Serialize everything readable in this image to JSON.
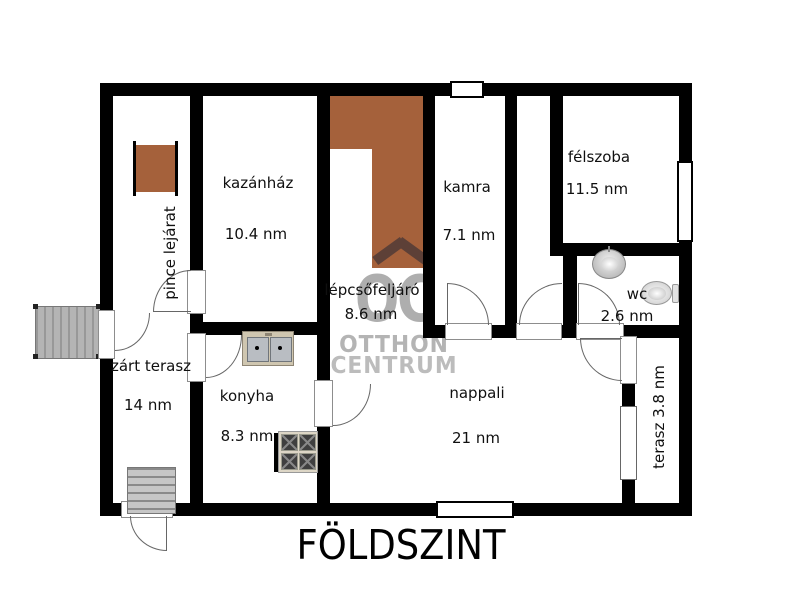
{
  "title": "FÖLDSZINT",
  "watermark": {
    "initials": "OC",
    "line1": "OTTHON",
    "line2": "CENTRUM"
  },
  "rooms": {
    "pince_lejarat": {
      "name": "pince lejárat"
    },
    "kazanhaz": {
      "name": "kazánház",
      "area": "10.4 nm"
    },
    "lepcsofeljaro": {
      "name": "lépcsőfeljáró",
      "area": "8.6 nm"
    },
    "kamra": {
      "name": "kamra",
      "area": "7.1 nm"
    },
    "felszoba": {
      "name": "félszoba",
      "area": "11.5 nm"
    },
    "wc": {
      "name": "wc",
      "area": "2.6 nm"
    },
    "zart_terasz": {
      "name": "zárt terasz",
      "area": "14 nm"
    },
    "konyha": {
      "name": "konyha",
      "area": "8.3 nm"
    },
    "nappali": {
      "name": "nappali",
      "area": "21 nm"
    },
    "terasz": {
      "name": "terasz 3.8 nm"
    }
  },
  "icons": {
    "kitchen_sink": "double-basin-sink-shape",
    "stove": "four-burner-stove-shape",
    "wc_sink": "round-washbasin-shape",
    "toilet": "toilet-with-tank-shape",
    "stairs": "tread-lines-shape",
    "deck": "plank-lines-shape",
    "roof": "chevron-roof-shape"
  },
  "colors": {
    "wall": "#000000",
    "staircase_brown": "#a5613b",
    "watermark_gray": "#b4b4b4",
    "roof_brown": "#5d4037",
    "fixture_tan": "#cfc6b0"
  }
}
